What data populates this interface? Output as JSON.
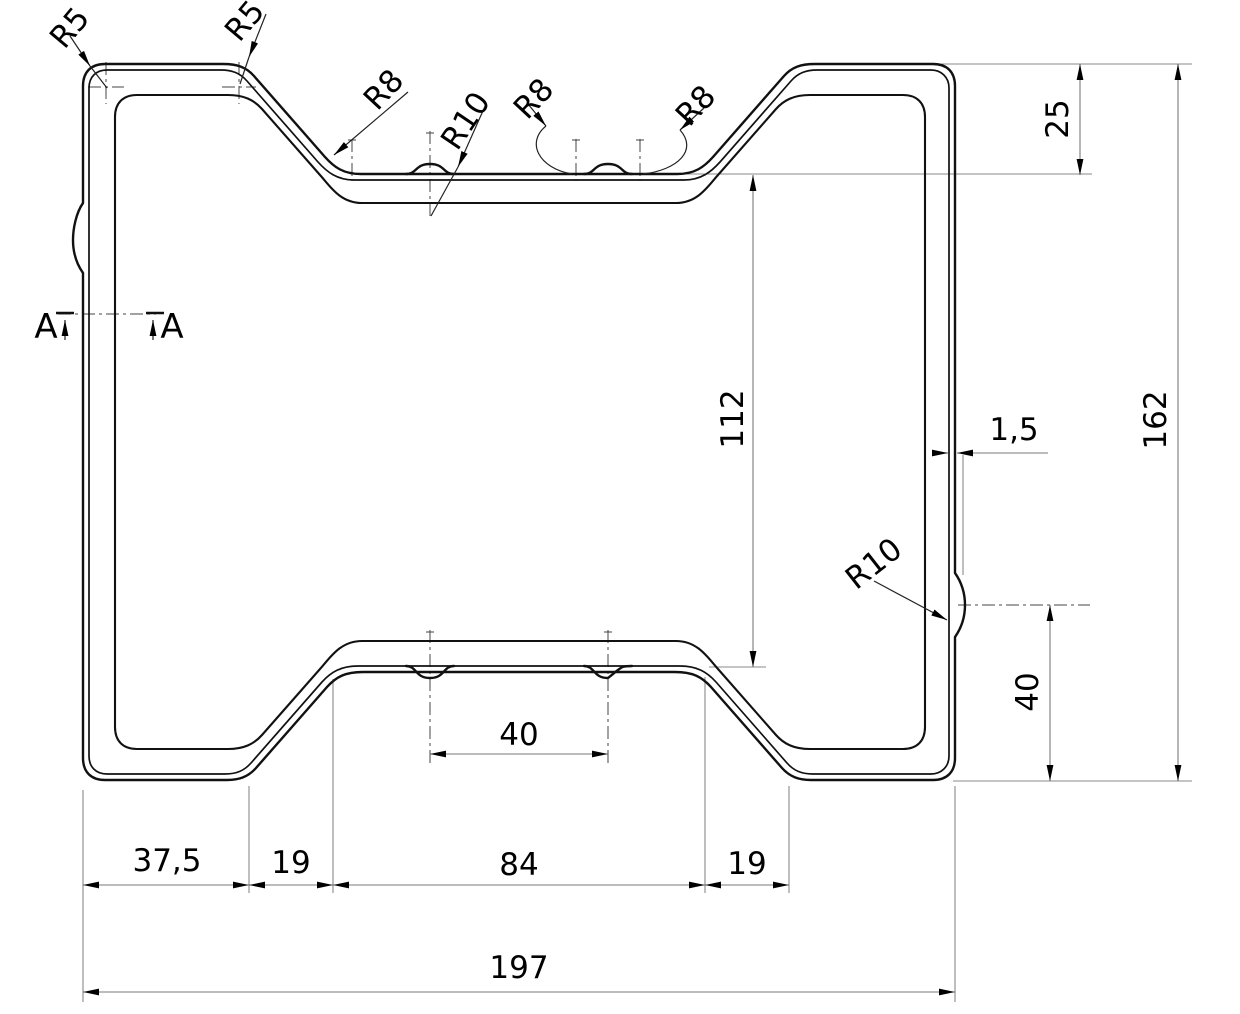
{
  "colors": {
    "background": "#ffffff",
    "line": "#111111",
    "dim": "#7a7a7a",
    "ext": "#8a8a8a",
    "center": "#444444",
    "leader": "#222222",
    "text": "#000000"
  },
  "drawing": {
    "type": "technical-cross-section",
    "radii": {
      "r5_left": "R5",
      "r5_right": "R5",
      "r8_left": "R8",
      "r10_top": "R10",
      "r8_mid": "R8",
      "r8_right": "R8",
      "r10_side": "R10"
    },
    "dims": {
      "channel_depth": "25",
      "overall_height": "162",
      "inner_height": "112",
      "wall_thickness": "1,5",
      "rib_height": "40",
      "bump_spacing": "40",
      "flat_left": "37,5",
      "slope_left": "19",
      "channel_width": "84",
      "slope_right": "19",
      "overall_width": "197"
    },
    "section_marks": {
      "left": "A",
      "right": "A"
    }
  }
}
